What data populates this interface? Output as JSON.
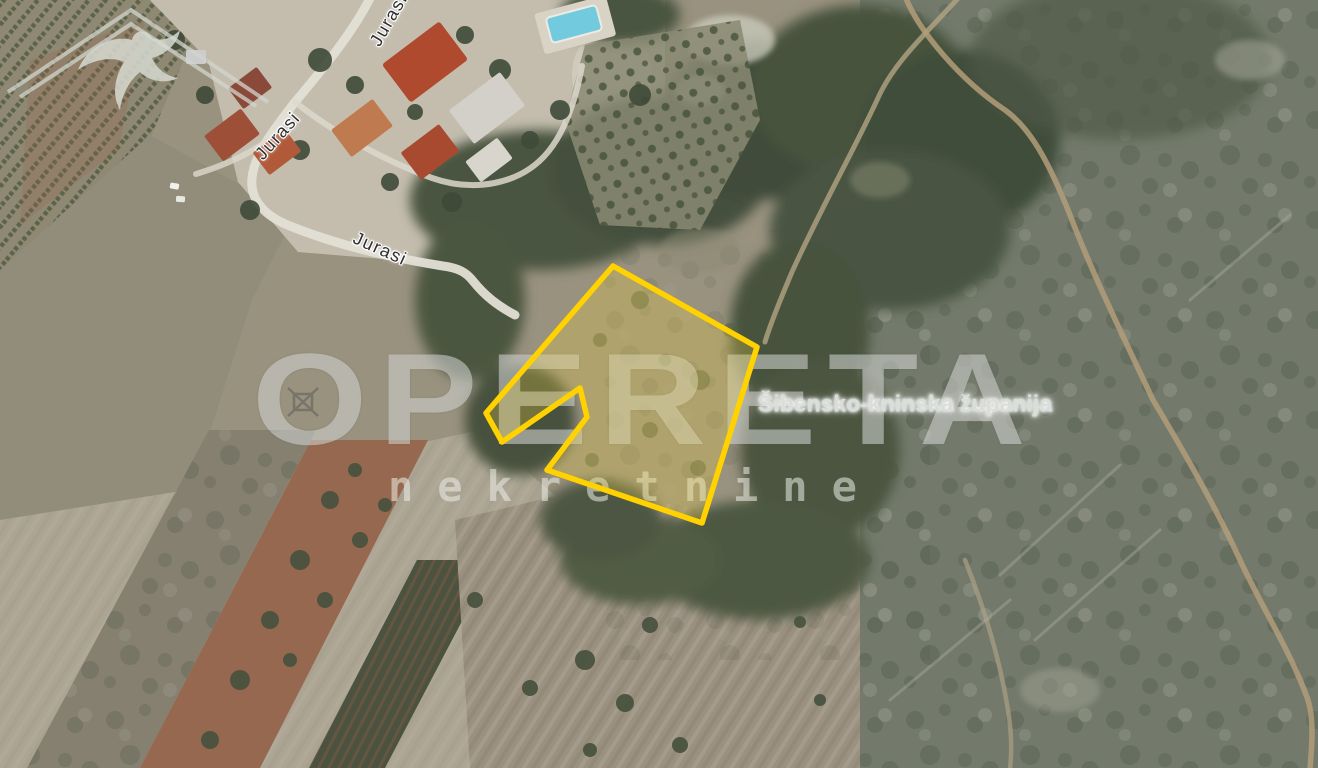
{
  "map": {
    "view": "satellite",
    "street_labels": [
      {
        "text": "Jurasi",
        "x": 389,
        "y": 20,
        "rotation_deg": -60
      },
      {
        "text": "Jurasi",
        "x": 278,
        "y": 136,
        "rotation_deg": -48
      },
      {
        "text": "Jurasi",
        "x": 380,
        "y": 249,
        "rotation_deg": 24
      }
    ],
    "region_label": {
      "text": "Šibensko-kninska županija",
      "x": 905,
      "y": 404
    },
    "parcel_highlight": {
      "points": "613,266 757,347 702,523 547,470 587,417 580,388 502,442 486,413",
      "stroke": "#FFD200",
      "fill": "#E8CC3F"
    },
    "palette": {
      "field_tan": "#9b9181",
      "pale_field": "#aca594",
      "forest_green": "#47523e",
      "scrub_gray_green": "#737a6b",
      "vineyard_dark": "#4b5340",
      "plowed_red_brown": "#96684f",
      "road_light": "#e3dfd6",
      "dirt_path_tan": "#b39e79",
      "roof_red": "#b04a2e",
      "pool_blue": "#72cadf"
    }
  },
  "watermark": {
    "brand": "OPERETA",
    "tagline": "nekretnine",
    "logo": "roof-swallow-icon",
    "color": "#e9ebe5"
  }
}
